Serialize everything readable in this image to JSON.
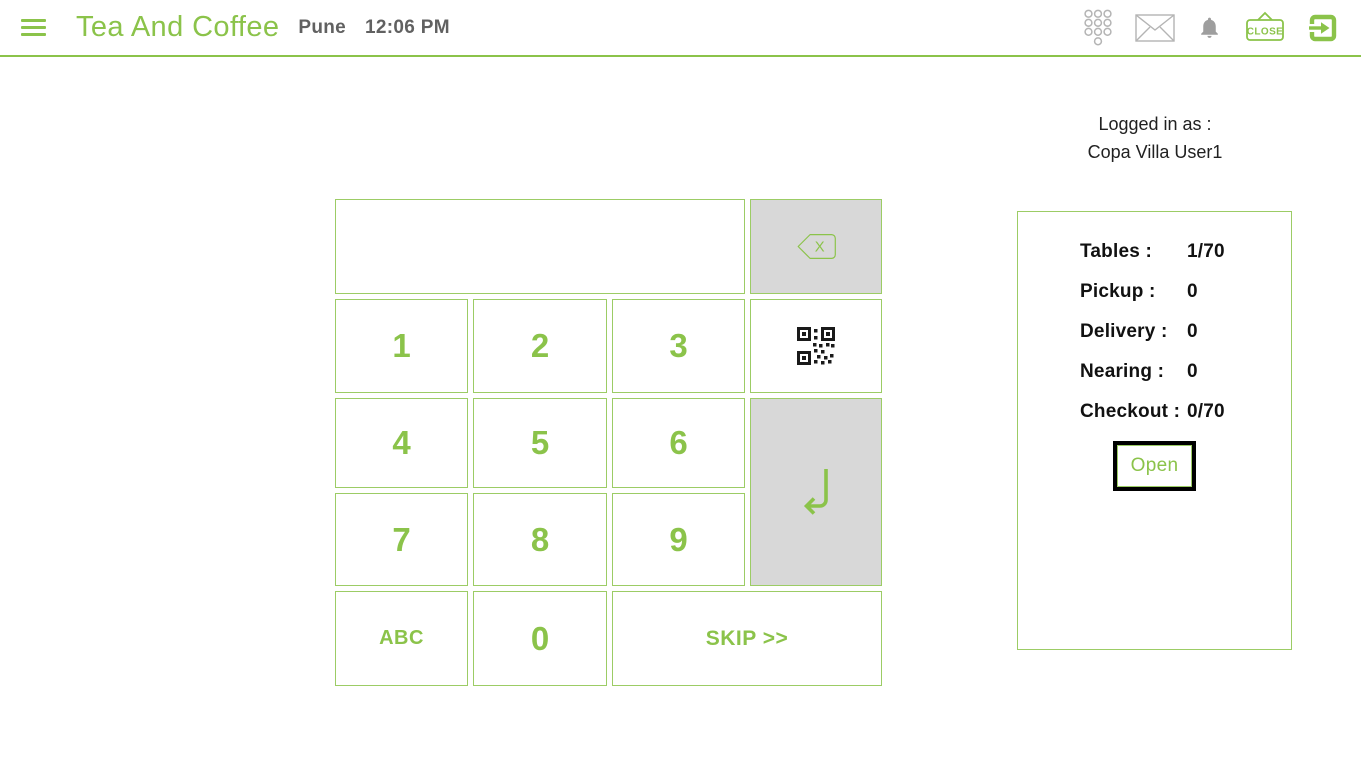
{
  "header": {
    "title": "Tea And Coffee",
    "location": "Pune",
    "time": "12:06 PM",
    "close_icon_text": "CLOSE",
    "icon_names": [
      "dialpad-icon",
      "mail-icon",
      "notifications-bell-icon",
      "close-sign-icon",
      "exit-icon"
    ]
  },
  "account": {
    "logged_in_label": "Logged in as :",
    "user_name": "Copa Villa User1"
  },
  "status_panel": {
    "rows": [
      {
        "label": "Tables :",
        "value": "1/70"
      },
      {
        "label": "Pickup :",
        "value": "0"
      },
      {
        "label": "Delivery :",
        "value": "0"
      },
      {
        "label": "Nearing :",
        "value": "0"
      },
      {
        "label": "Checkout :",
        "value": "0/70"
      }
    ],
    "open_button_label": "Open"
  },
  "keypad": {
    "display_value": "",
    "digits": [
      "1",
      "2",
      "3",
      "4",
      "5",
      "6",
      "7",
      "8",
      "9"
    ],
    "zero_label": "0",
    "abc_label": "ABC",
    "skip_label": "SKIP >>",
    "backspace_glyph": "X",
    "icon_names": [
      "backspace-icon",
      "qr-code-icon",
      "enter-icon"
    ]
  },
  "colors": {
    "accent_green": "#8bc34a",
    "border_green": "#9ccc65",
    "key_gray_bg": "#d8d8d8",
    "icon_gray": "#9e9e9e",
    "text_dark": "#212121",
    "text_gray": "#616161"
  }
}
